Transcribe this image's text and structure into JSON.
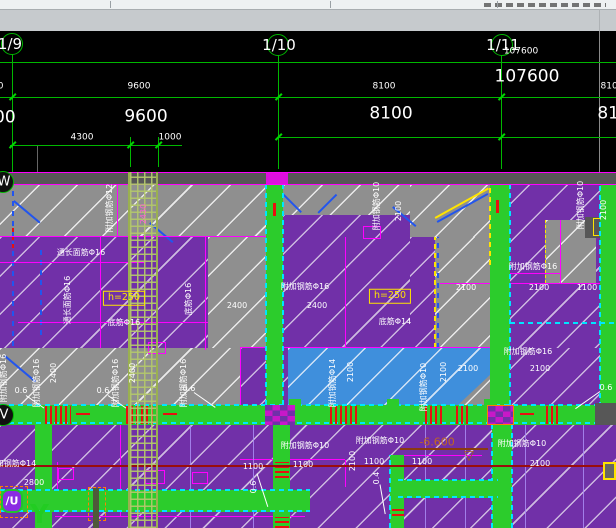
{
  "grid_bubbles": {
    "b9": "1/9",
    "b10": "1/10",
    "b11": "1/11",
    "row_w": "W",
    "row_v": "V",
    "row_u": "/U"
  },
  "colors": {
    "purple": "#7130a8",
    "slab_gray": "#8f8f8f",
    "beam_green": "#2ccc2c",
    "slab_blue": "#3f8fdc",
    "magenta": "#ff00ff",
    "cyan": "#00e5ff",
    "dim_green": "#00b800",
    "yellow": "#ffe400",
    "red": "#e81010",
    "dark_red": "#9a0d0d",
    "violet": "#a98cf5",
    "elevation_orange": "#c06820"
  },
  "cad_labels": [
    {
      "t": "9600",
      "x": -8,
      "y": 87,
      "s": 9
    },
    {
      "t": "9600",
      "x": 139,
      "y": 87,
      "s": 9
    },
    {
      "t": "8100",
      "x": 384,
      "y": 87,
      "s": 9
    },
    {
      "t": "8100",
      "x": 612,
      "y": 87,
      "s": 9
    },
    {
      "t": "107600",
      "x": 521,
      "y": 52,
      "s": 9
    },
    {
      "t": "9600",
      "x": -6,
      "y": 118,
      "s": 17
    },
    {
      "t": "9600",
      "x": 146,
      "y": 117,
      "s": 17
    },
    {
      "t": "107600",
      "x": 527,
      "y": 77,
      "s": 17
    },
    {
      "t": "8100",
      "x": 391,
      "y": 114,
      "s": 17
    },
    {
      "t": "8100",
      "x": 619,
      "y": 114,
      "s": 17
    },
    {
      "t": "4300",
      "x": 82,
      "y": 138,
      "s": 9
    },
    {
      "t": "1000",
      "x": 170,
      "y": 138,
      "s": 9
    }
  ],
  "plan_labels": [
    {
      "t": "附加钢筋Φ12",
      "x": 110,
      "y": 208,
      "v": 1
    },
    {
      "t": "2430",
      "x": 144,
      "y": 214,
      "v": 1,
      "c": "#ff5fd6"
    },
    {
      "t": "通长面筋Φ16",
      "x": 81,
      "y": 253
    },
    {
      "t": "通长面筋Φ16",
      "x": 68,
      "y": 300,
      "v": 1
    },
    {
      "t": "h=250",
      "x": 124,
      "y": 298,
      "box": 1,
      "c": "#ffe400",
      "s": 9.5
    },
    {
      "t": "底筋Φ16",
      "x": 124,
      "y": 323
    },
    {
      "t": "底筋Φ16",
      "x": 189,
      "y": 299,
      "v": 1
    },
    {
      "t": "附加钢筋Φ10",
      "x": 377,
      "y": 206,
      "v": 1
    },
    {
      "t": "2100",
      "x": 399,
      "y": 211,
      "v": 1
    },
    {
      "t": "附加钢筋Φ16",
      "x": 305,
      "y": 287
    },
    {
      "t": "2400",
      "x": 237,
      "y": 306
    },
    {
      "t": "2400",
      "x": 317,
      "y": 306
    },
    {
      "t": "h=250",
      "x": 390,
      "y": 296,
      "box": 1,
      "c": "#ffe400",
      "s": 9.5
    },
    {
      "t": "底筋Φ14",
      "x": 395,
      "y": 322
    },
    {
      "t": "附加钢筋Φ16",
      "x": 533,
      "y": 267
    },
    {
      "t": "2100",
      "x": 466,
      "y": 288
    },
    {
      "t": "2100",
      "x": 539,
      "y": 288
    },
    {
      "t": "1100",
      "x": 587,
      "y": 288
    },
    {
      "t": "附加钢筋Φ10",
      "x": 581,
      "y": 205,
      "v": 1
    },
    {
      "t": "2100",
      "x": 604,
      "y": 210,
      "v": 1
    },
    {
      "t": "附加钢筋Φ16",
      "x": 4,
      "y": 378,
      "v": 1
    },
    {
      "t": "附加钢筋Φ16",
      "x": 37,
      "y": 383,
      "v": 1
    },
    {
      "t": "2400",
      "x": 54,
      "y": 373,
      "v": 1
    },
    {
      "t": "附加钢筋Φ16",
      "x": 116,
      "y": 383,
      "v": 1
    },
    {
      "t": "2400",
      "x": 133,
      "y": 373,
      "v": 1
    },
    {
      "t": "附加钢筋Φ16",
      "x": 184,
      "y": 383,
      "v": 1
    },
    {
      "t": "0.6",
      "x": 21,
      "y": 391
    },
    {
      "t": "0.6",
      "x": 103,
      "y": 391
    },
    {
      "t": "0.6",
      "x": 189,
      "y": 389
    },
    {
      "t": "0.6",
      "x": 606,
      "y": 388
    },
    {
      "t": "附加钢筋Φ14",
      "x": 333,
      "y": 383,
      "v": 1
    },
    {
      "t": "2100",
      "x": 351,
      "y": 372,
      "v": 1
    },
    {
      "t": "附加钢筋Φ10",
      "x": 424,
      "y": 387,
      "v": 1
    },
    {
      "t": "2100",
      "x": 444,
      "y": 372,
      "v": 1
    },
    {
      "t": "2100",
      "x": 468,
      "y": 369
    },
    {
      "t": "附加钢筋Φ16",
      "x": 528,
      "y": 352
    },
    {
      "t": "2100",
      "x": 540,
      "y": 369
    },
    {
      "t": "附加钢筋Φ14",
      "x": 12,
      "y": 464
    },
    {
      "t": "2800",
      "x": 34,
      "y": 483
    },
    {
      "t": "附加钢筋Φ10",
      "x": 305,
      "y": 446
    },
    {
      "t": "1100",
      "x": 253,
      "y": 467
    },
    {
      "t": "1100",
      "x": 303,
      "y": 465
    },
    {
      "t": "2100",
      "x": 353,
      "y": 461,
      "v": 1
    },
    {
      "t": "附加钢筋Φ10",
      "x": 380,
      "y": 441
    },
    {
      "t": "1100",
      "x": 374,
      "y": 462
    },
    {
      "t": "0.6",
      "x": 254,
      "y": 487,
      "v": 1
    },
    {
      "t": "0.4",
      "x": 377,
      "y": 478,
      "v": 1
    },
    {
      "t": "-6.600",
      "x": 437,
      "y": 442,
      "c": "#c06820",
      "s": 11
    },
    {
      "t": "1100",
      "x": 422,
      "y": 462
    },
    {
      "t": "附加钢筋Φ10",
      "x": 522,
      "y": 444
    },
    {
      "t": "2100",
      "x": 540,
      "y": 464
    },
    {
      "t": "▽",
      "x": 469,
      "y": 456,
      "c": "#a85a18",
      "s": 13
    }
  ]
}
